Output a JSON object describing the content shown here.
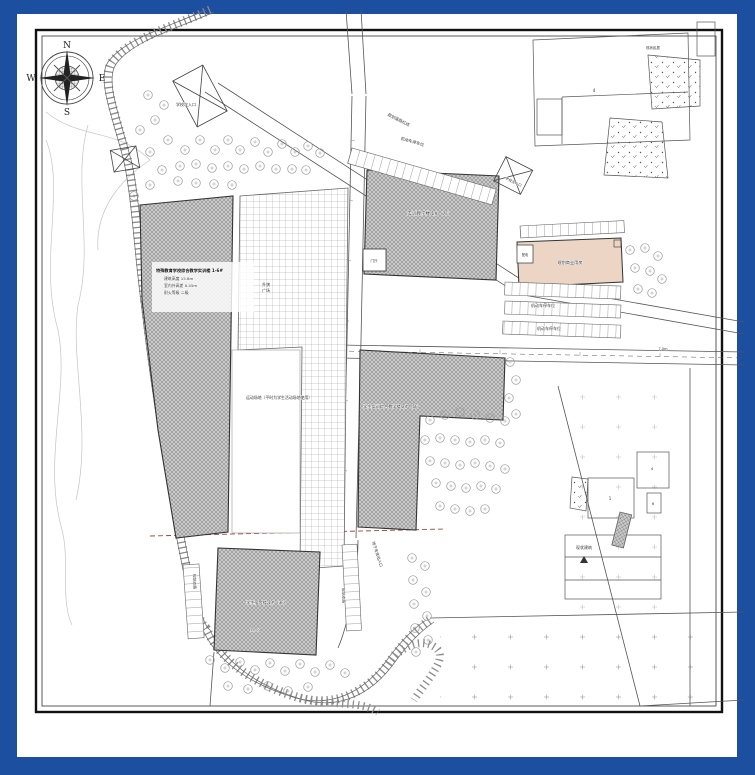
{
  "document": {
    "type": "site-plan-drawing",
    "frame_color": "#1d4fa0",
    "paper_color": "#ffffff",
    "line_color": "#444444",
    "hatch_fill": "#c6c6c6",
    "pink_fill": "#ecd5c4",
    "red_line": "#a3493f"
  },
  "compass": {
    "n": "N",
    "e": "E",
    "s": "S",
    "w": "W"
  },
  "labels": {
    "gate_north": "学校次入口",
    "road_top": "规划道路红线",
    "parking_top": "机动车停车位",
    "building_b": "实训教学楼 1#（7F）",
    "annex_b": "门厅",
    "pink": "规划商业用房",
    "annex_pink": "配电",
    "gate_main": "学校主入口",
    "parking_r1": "机动车停车位",
    "parking_r2": "机动车停车位",
    "plaza_1": "升旗",
    "plaza_2": "广场",
    "bldg_a_1": "特殊教育学校综合教学实训楼 1-6#",
    "bldg_a_2": "建筑高度 15.8m",
    "bldg_a_3": "室内外高差 0.45m",
    "bldg_a_4": "耐火等级 二级",
    "field": "运动场地（平时为学生活动场地使用）",
    "building_c": "学生实训综合教学楼 2#（5F）",
    "building_d": "学生宿舍楼 1#（3F）",
    "d_note": "±0.00",
    "v_left": "规划支路",
    "v_right": "规划支路",
    "v_ramp": "地下车库出入口",
    "existing": "现状建筑",
    "village": "现状民居",
    "dim_right": "7.0m",
    "num_tr": "4",
    "num_1": "1",
    "num_4": "4",
    "num_6": "6"
  }
}
